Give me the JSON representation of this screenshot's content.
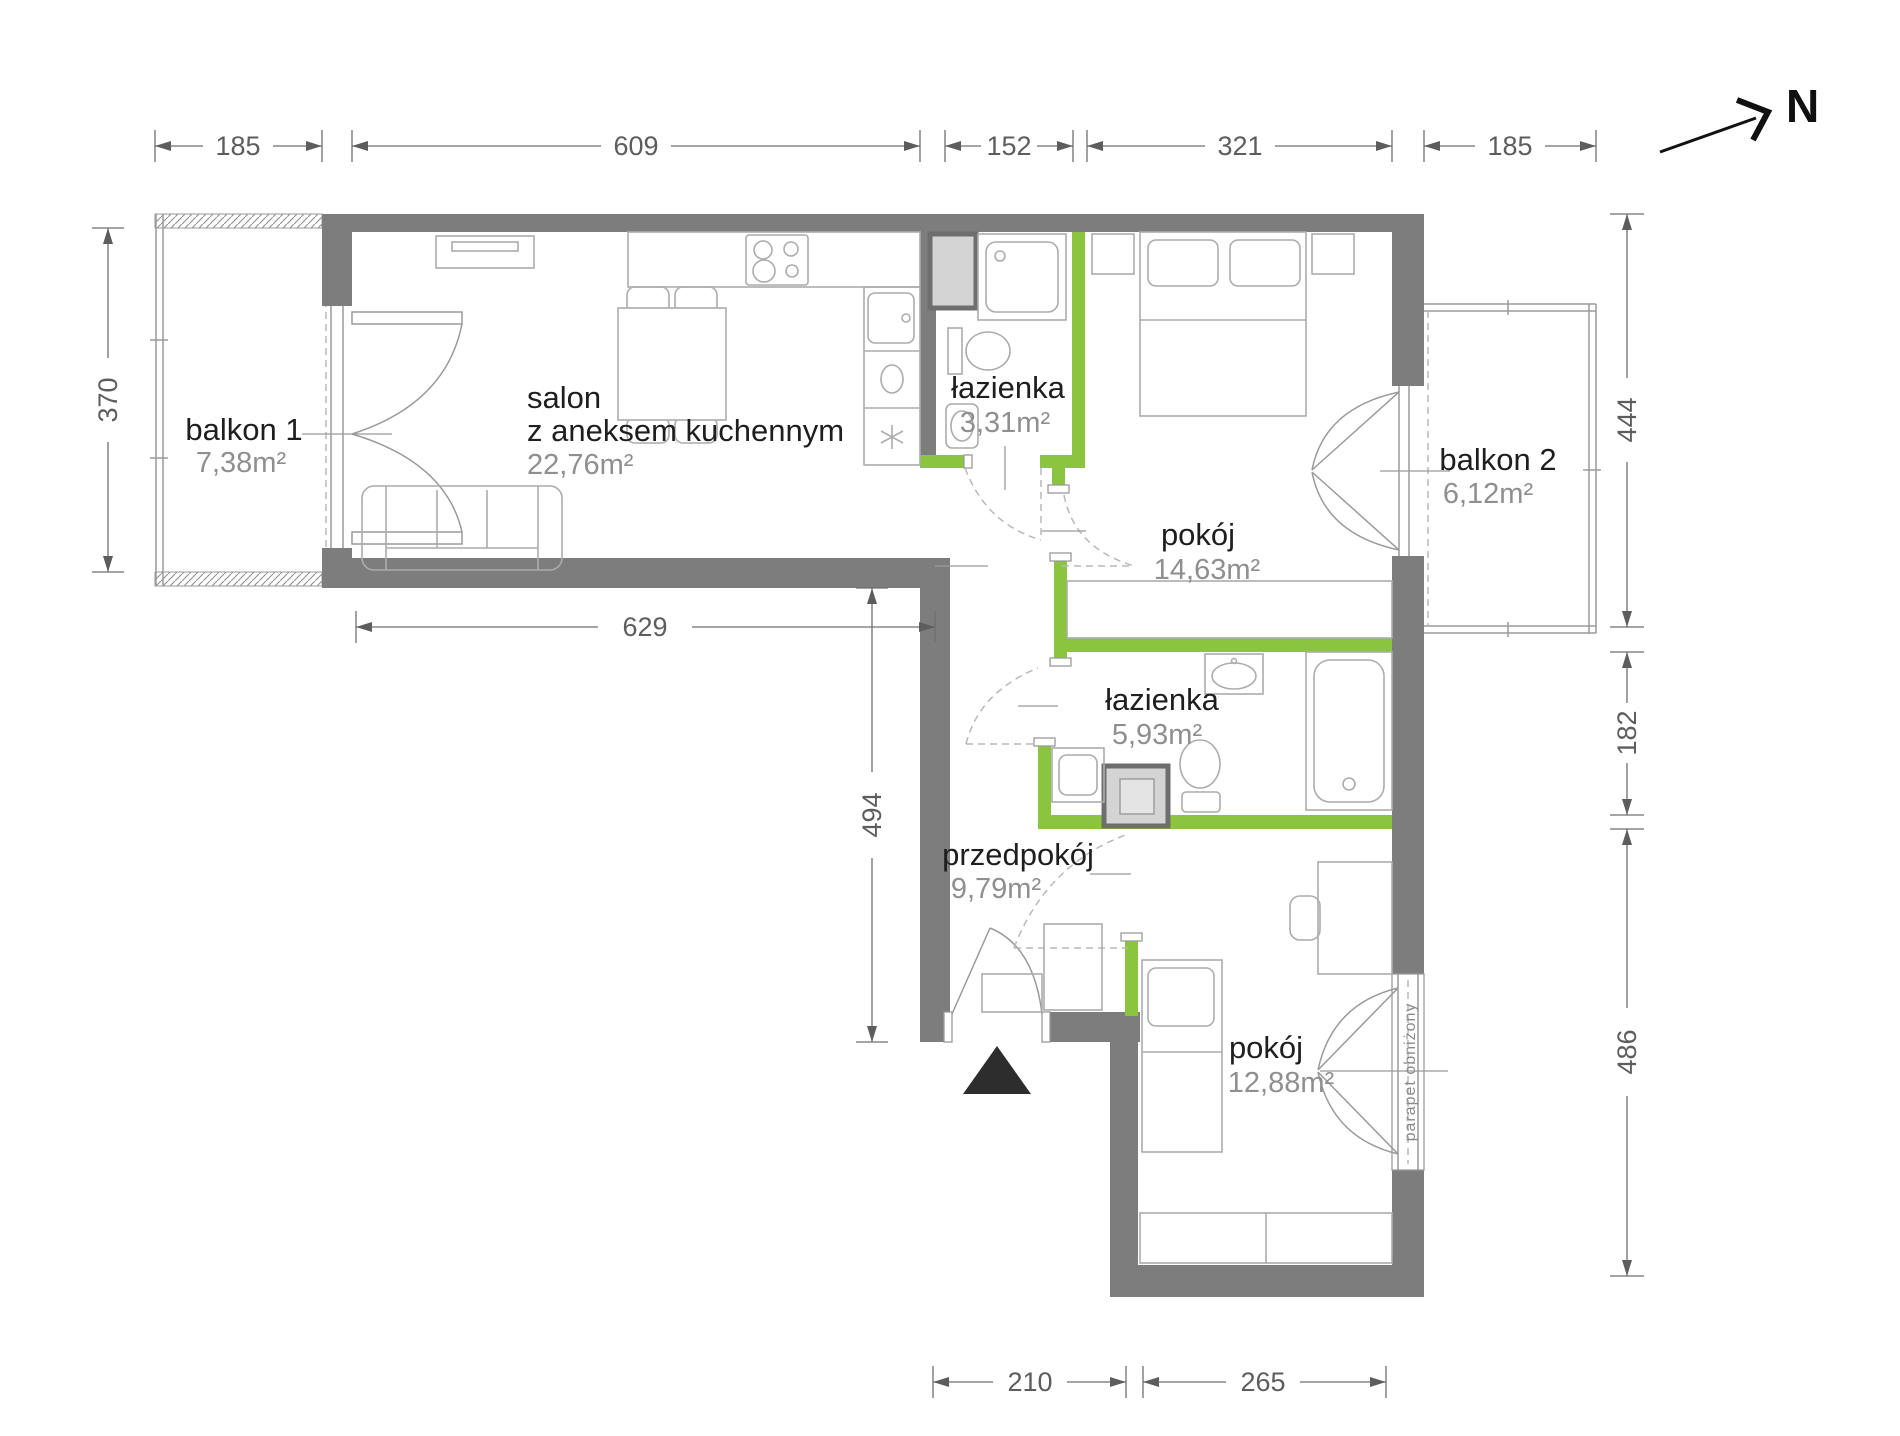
{
  "plan": {
    "north_label": "N",
    "window_note": "parapet obniżony",
    "rooms": {
      "salon": {
        "name_line1": "salon",
        "name_line2": "z aneksem kuchennym",
        "area": "22,76m²"
      },
      "lazienka_gorna": {
        "name": "łazienka",
        "area": "3,31m²"
      },
      "pokoj_1": {
        "name": "pokój",
        "area": "14,63m²"
      },
      "lazienka_dolna": {
        "name": "łazienka",
        "area": "5,93m²"
      },
      "przedpokoj": {
        "name": "przedpokój",
        "area": "9,79m²"
      },
      "pokoj_2": {
        "name": "pokój",
        "area": "12,88m²"
      },
      "balkon_1": {
        "name": "balkon 1",
        "area": "7,38m²"
      },
      "balkon_2": {
        "name": "balkon 2",
        "area": "6,12m²"
      }
    },
    "dimensions": {
      "top": [
        "185",
        "609",
        "152",
        "321",
        "185"
      ],
      "left_balcony": "370",
      "left_inner": "629",
      "left_lower": "494",
      "right": [
        "444",
        "182",
        "486"
      ],
      "bottom": [
        "210",
        "265"
      ]
    },
    "colors": {
      "wall": "#7d7d7d",
      "partition": "#8bc53f",
      "shaft_fill": "#d4d4d4"
    }
  }
}
